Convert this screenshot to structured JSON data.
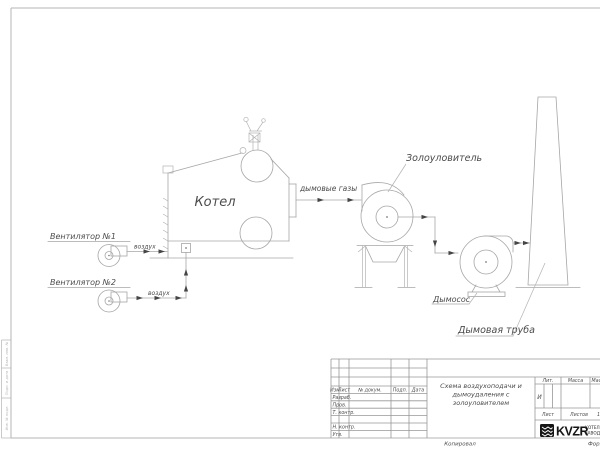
{
  "drawing": {
    "labels": {
      "fan1": "Вентилятор №1",
      "fan2": "Вентилятор №2",
      "air": "воздух",
      "boiler": "Котел",
      "flue_gases": "дымовые газы",
      "ash_collector": "Золоуловитель",
      "smoke_exhauster": "Дымосос",
      "chimney": "Дымовая труба"
    }
  },
  "title_block": {
    "doc_title_line1": "Схема воздухоподачи и",
    "doc_title_line2": "дымоудаления с",
    "doc_title_line3": "золоуловителем",
    "col_izm": "Изм",
    "col_list": "Лист",
    "col_ndoc": "№ докум.",
    "col_podp": "Подп.",
    "col_data": "Дата",
    "row_razrab": "Разраб.",
    "row_prov": "Пров.",
    "row_tkontr": "Т. контр.",
    "row_nkontr": "Н. контр.",
    "row_utv": "Утв.",
    "lit_label": "Лит.",
    "lit_value": "И",
    "mass_label": "Масса",
    "scale_label": "Масштаб",
    "sheet_label": "Лист",
    "sheets_label": "Листов",
    "sheets_value": "1",
    "logo_text": "KVZR",
    "org_line1": "КОТЕЛЬНЫЙ",
    "org_line2": "ЗАВОД",
    "copied_label": "Копировал",
    "format_label": "Формат А4"
  },
  "margin_stamp": {
    "cell_top": "Взам. инв. №",
    "cell_mid": "Подп. и дата",
    "cell_bottom": "Инв. № подл."
  }
}
